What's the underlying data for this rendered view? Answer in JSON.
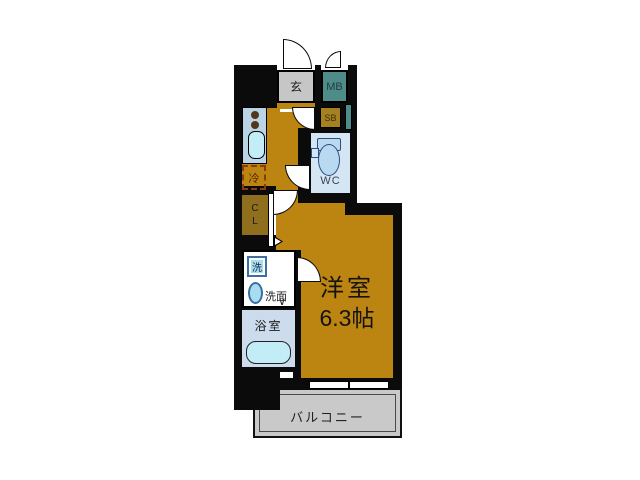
{
  "plan": {
    "labels": {
      "genkan": "玄",
      "meter_box": "MB",
      "shoe_box": "SB",
      "wc": "WC",
      "fridge": "冷",
      "closet_l1": "C",
      "closet_l2": "L",
      "washer": "洗",
      "washstand": "洗面",
      "bathroom": "浴室",
      "main_room_l1": "洋室",
      "main_room_l2": "6.3帖",
      "balcony": "バルコニー",
      "bath_door_mark": "∨"
    },
    "colors": {
      "wall": "#0b0b0b",
      "floor": "#bc8410",
      "closet": "#8f6f1d",
      "shoe-box": "#a5821f",
      "meter-box": "#4e8c8a",
      "genkan": "#c6c6c6",
      "wet-room": "#d4e5f4",
      "bath-room": "#ccdcec",
      "fixture-cyan": "#c3edf6",
      "counter": "#b9d4e5",
      "washer-fill": "#a8dcee",
      "washer-border": "#3a6ea5",
      "toilet-fill": "#b9d9f0",
      "toilet-border": "#2f4f80",
      "balcony": "#c9c9c9",
      "fridge-border": "#8b3a10",
      "fridge-text": "#5a2505",
      "label-dark": "#1a1a1a",
      "wc-text": "#3c4650"
    }
  }
}
